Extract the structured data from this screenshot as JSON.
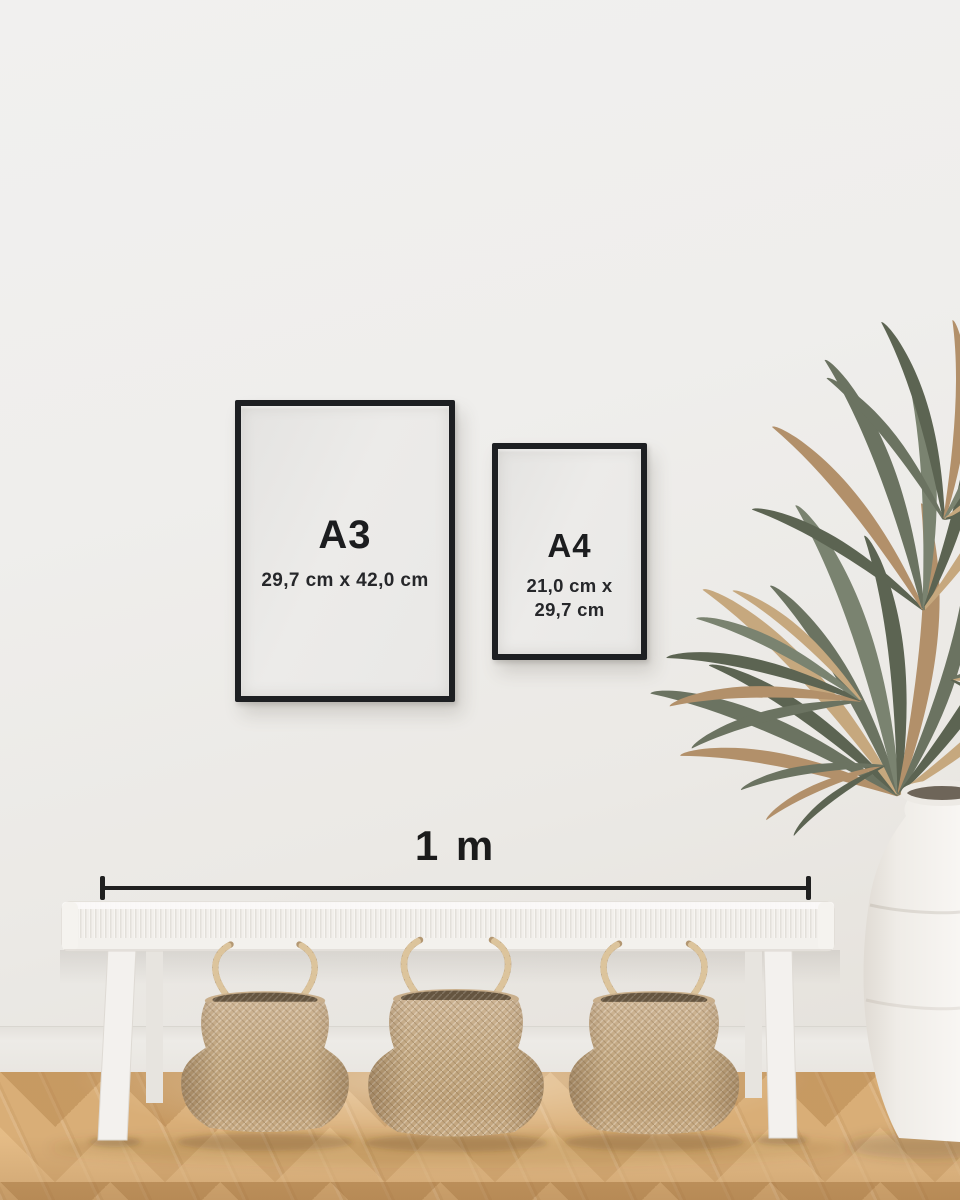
{
  "size_guide": {
    "frames": [
      {
        "id": "a3",
        "label": "A3",
        "dimensions": [
          "29,7 cm x 42,0 cm"
        ]
      },
      {
        "id": "a4",
        "label": "A4",
        "dimensions": [
          "21,0 cm x",
          "29,7 cm"
        ]
      }
    ],
    "scale_bar": {
      "label": "1 m"
    }
  },
  "colors": {
    "frame_border": "#1d1f22",
    "frame_paper": "#e9e8e6",
    "text": "#1c1d1f",
    "wall": "#efeeec",
    "baseboard": "#edebe7",
    "floor_wood": "#d9ae77",
    "bench_white": "#f5f3f0",
    "basket_seagrass": "#c2a780",
    "plant_green": "#6b7361",
    "plant_tan": "#b2906a",
    "vase_white": "#f1eeea"
  }
}
